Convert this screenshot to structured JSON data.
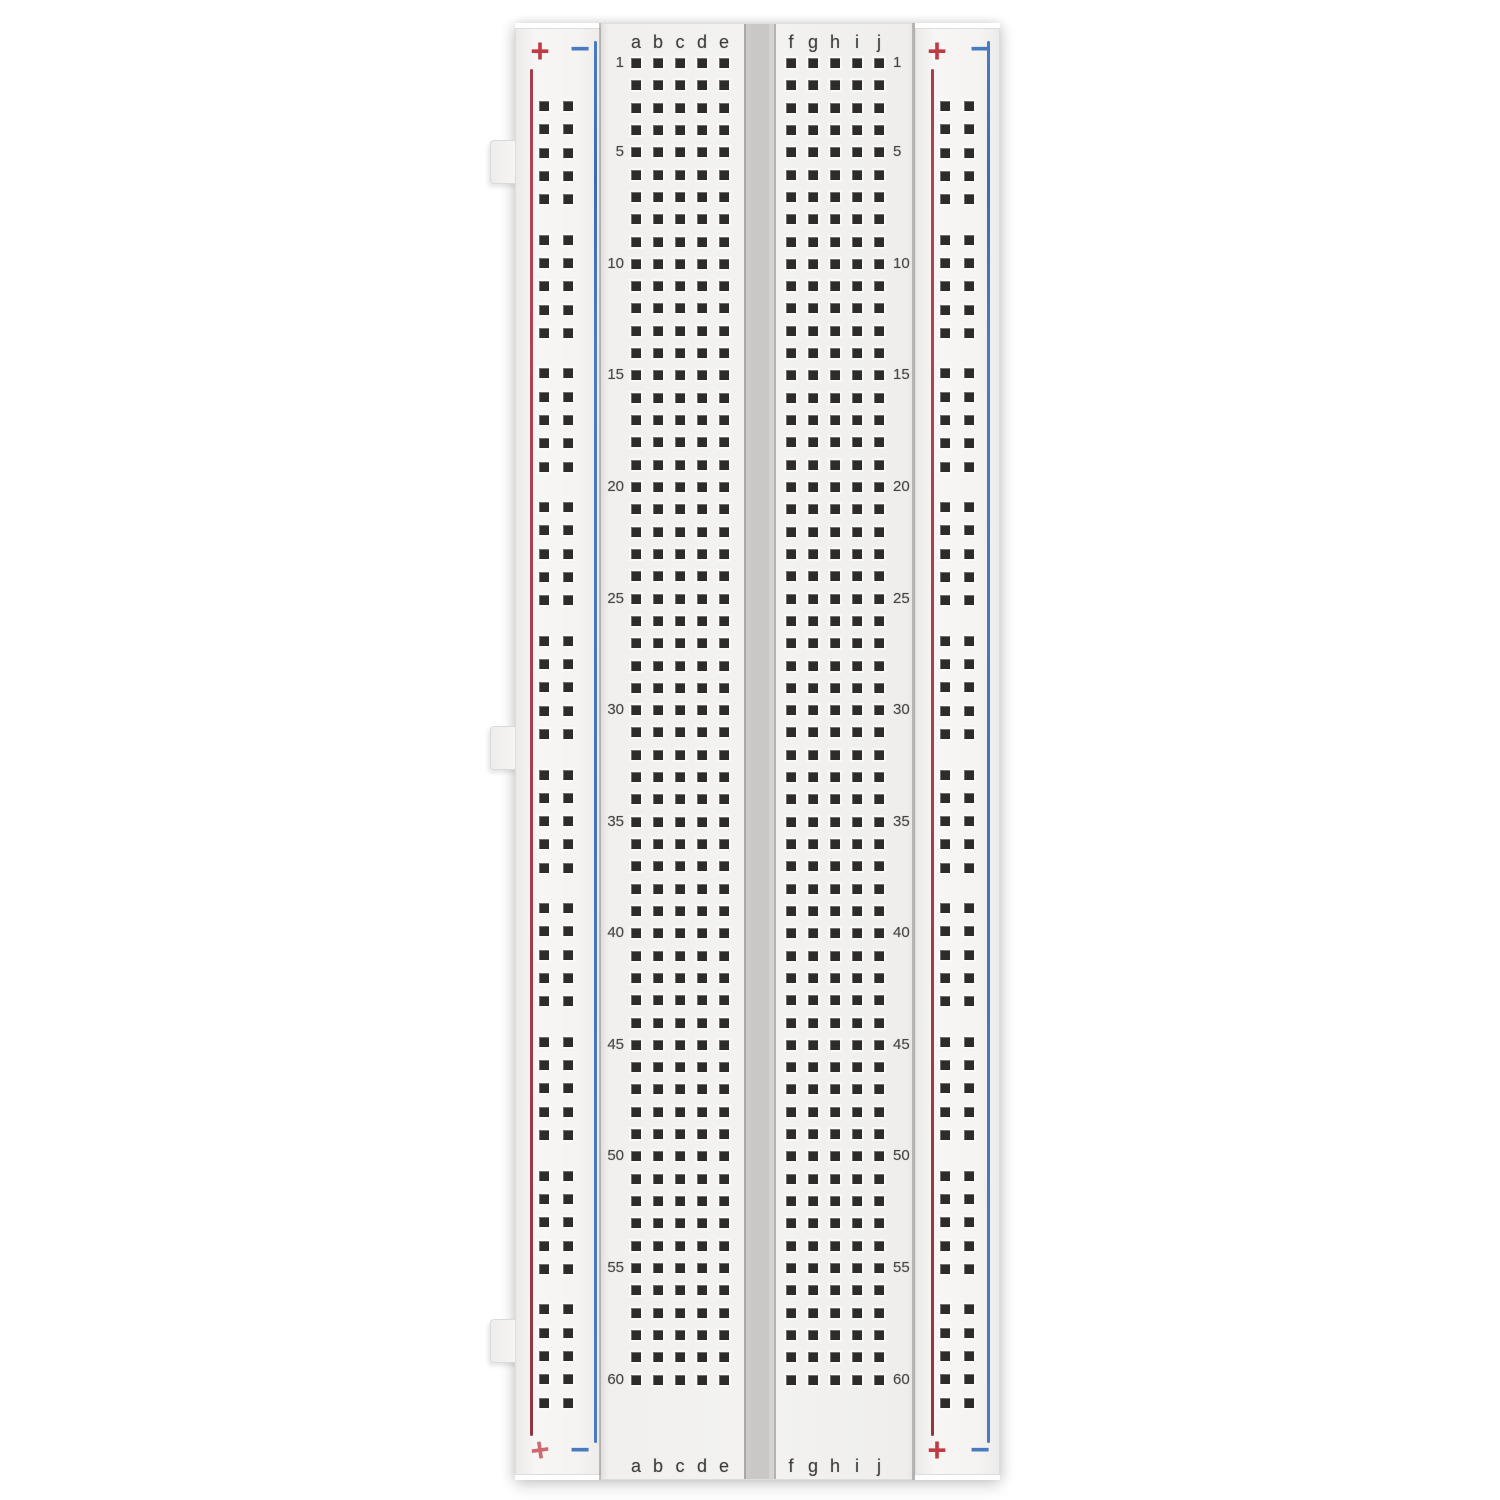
{
  "colors": {
    "background": "#ffffff",
    "board_plastic": "#f3f2f0",
    "center_channel": "#c9c8c6",
    "hole": "#2d2c2a",
    "positive_line_red": "#a63c4c",
    "negative_line_blue": "#4a7ac1",
    "plus_symbol_red": "#c23b44",
    "minus_symbol_blue": "#4a7ac1",
    "label_text": "#3e3e3e"
  },
  "left_rail": {
    "plus": "+",
    "minus": "−"
  },
  "right_rail": {
    "plus": "+",
    "minus": "−"
  },
  "terminal_strip": {
    "rows": 60,
    "left_column_labels": [
      "a",
      "b",
      "c",
      "d",
      "e"
    ],
    "right_column_labels": [
      "f",
      "g",
      "h",
      "i",
      "j"
    ],
    "row_number_labels": [
      "1",
      "5",
      "10",
      "15",
      "20",
      "25",
      "30",
      "35",
      "40",
      "45",
      "50",
      "55",
      "60"
    ]
  },
  "power_rails": {
    "hole_groups": 10,
    "holes_per_group": 5,
    "hole_columns": 2
  }
}
